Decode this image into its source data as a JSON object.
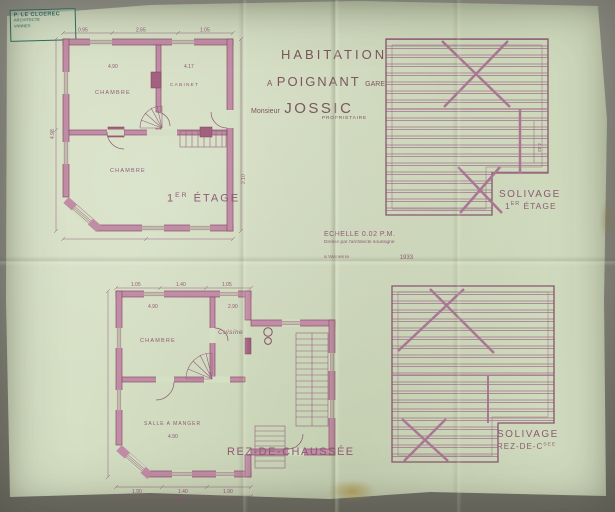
{
  "stamp": {
    "line1": "P. LE CLOEREC",
    "line2": "ARCHITECTE",
    "line3": "VANNES"
  },
  "title": {
    "line1": "HABITATION",
    "line2_prefix": "A",
    "line2_place": "POIGNANT",
    "line2_suffix": "GARE",
    "owner_prefix": "Monsieur",
    "owner_name": "JOSSIC",
    "owner_role": "PROPRIETAIRE"
  },
  "scale_note": {
    "line1": "ECHELLE 0.02 P.M.",
    "line2": "Dressé par l'architecte soussigné",
    "line3": "à Vannes le",
    "year": "1933"
  },
  "plan_etage": {
    "label_num": "1",
    "label_sup": "ER",
    "label_word": "ÉTAGE",
    "room_tl": "CHAMBRE",
    "room_tr": "CABINET",
    "room_b": "CHAMBRE"
  },
  "plan_rdc": {
    "label": "REZ-DE-CHAUSSÉE",
    "room_tl": "CHAMBRE",
    "room_tr": "Cuisine",
    "room_b": "SALLE A MANGER"
  },
  "solivage_etage": {
    "line1": "SOLIVAGE",
    "line2_num": "1",
    "line2_sup": "ER",
    "line2_word": "ÉTAGE"
  },
  "solivage_rdc": {
    "line1": "SOLIVAGE",
    "line2_main": "REZ-DE-C",
    "line2_sup": "SEE"
  },
  "dims": {
    "etage_top_0": "0.95",
    "etage_top_1": "2.65",
    "etage_top_2": "1.05",
    "etage_room_tl": "4.90",
    "etage_room_tr": "4.17",
    "etage_left": "4.98",
    "etage_right": "2.10",
    "rdc_top_0": "1.05",
    "rdc_top_1": "1.40",
    "rdc_top_2": "1.05",
    "rdc_room_tl": "4.90",
    "rdc_room_tr": "2.90",
    "rdc_sam": "4.90",
    "rdc_bottom_0": "1.90",
    "rdc_bottom_1": "1.40",
    "rdc_bottom_2": "1.90",
    "rdc_total": "6.50",
    "sol_right": "4.43"
  }
}
